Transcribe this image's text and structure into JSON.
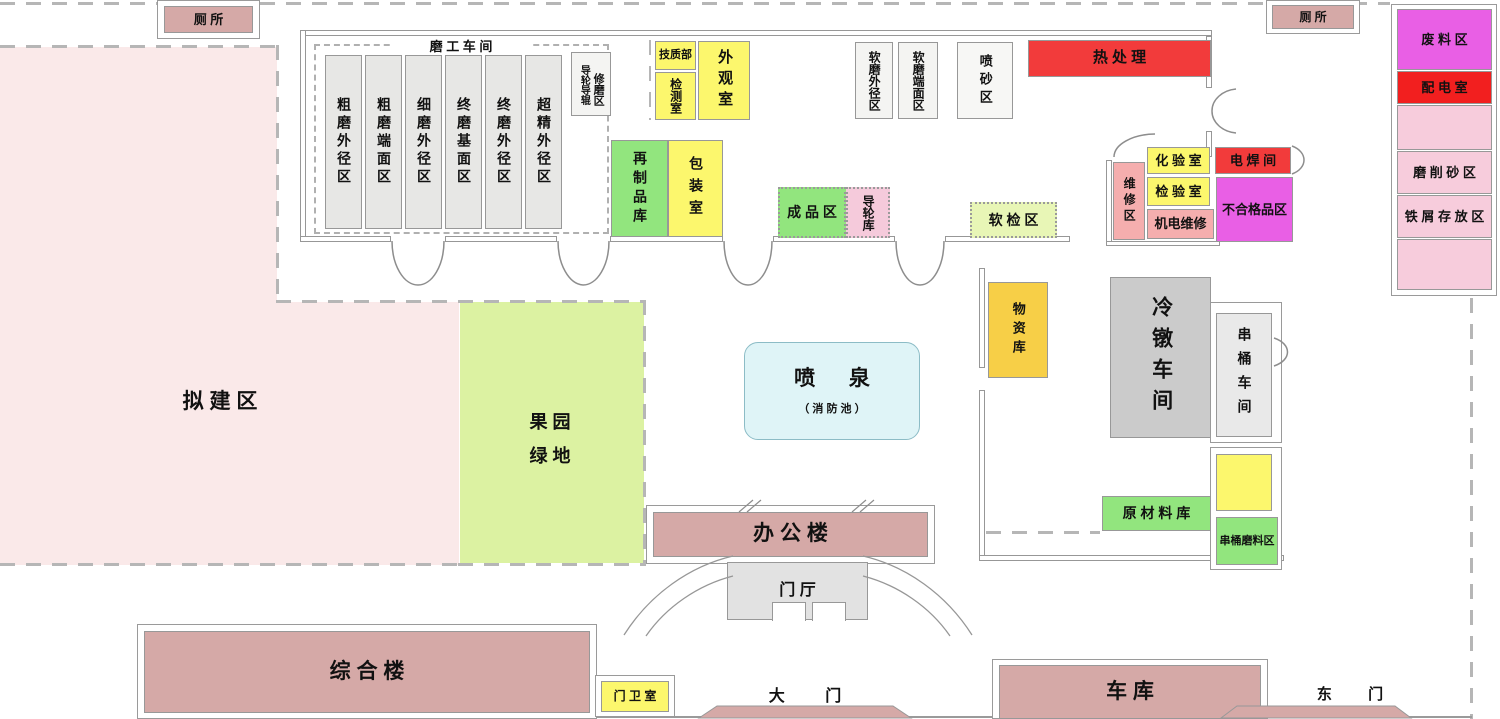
{
  "palette": {
    "building_mauve": "#D5A9A7",
    "proposed_pink": "#FAE9E9",
    "orchard_green": "#DCF2A2",
    "strip_gray": "#E7E7E5",
    "lemon_yellow": "#FCF76D",
    "gold_yellow": "#F7CF47",
    "hot_red": "#F23B3B",
    "power_red": "#F21F1F",
    "fresh_green": "#92E57E",
    "magenta": "#E95FE5",
    "soft_pink": "#F5AEAE",
    "pale_rose": "#F5CADB",
    "pale_lime": "#E8F6B6",
    "fountain_cyan": "#DFF4F7",
    "cold_gray": "#CBCBCB",
    "light_gray": "#E9E9E9",
    "wall_gray": "#989898"
  },
  "toilets": {
    "nw": "厕  所",
    "ne": "厕  所"
  },
  "grounds": {
    "proposed_area": "拟  建  区",
    "orchard_line1": "果  园",
    "orchard_line2": "绿  地"
  },
  "workshop": {
    "title": "磨 工 车 间",
    "strips": [
      "粗磨外径区",
      "粗磨端面区",
      "细磨外径区",
      "终磨基面区",
      "终磨外径区",
      "超精外径区"
    ],
    "regrind_line1": "导轮导辊",
    "regrind_line2": "修磨区",
    "tech_dept": "技质部",
    "testing_room": "检测室",
    "appearance_room": "外观室",
    "soft_grind_od": "软磨外径区",
    "soft_grind_face": "软磨端面区",
    "sandblast": "喷砂区",
    "heat_treatment": "热  处  理"
  },
  "mid": {
    "remanufactured_store": "再制品库",
    "packing_room": "包装室",
    "finished_goods": "成 品 区",
    "guide_wheel_store": "导轮库",
    "soft_inspection": "软 检 区"
  },
  "qc": {
    "lab": "化 验 室",
    "welding_room": "电 焊 间",
    "maintenance_area": "维修区",
    "inspection_room": "检 验 室",
    "mech_elec_maintenance": "机电维修",
    "nonconforming_area": "不合格品区"
  },
  "fountain": {
    "title": "喷  泉",
    "subtitle": "（ 消 防 池 ）"
  },
  "east_zone": {
    "materials_store": "物资库",
    "cold_heading_shop": "冷镦车间",
    "tumbling_shop": "串桶车间",
    "raw_materials_store": "原 材 料 库",
    "tumbling_abrasive_area": "串桶磨料区"
  },
  "east_column": {
    "waste_area": "废 料 区",
    "power_room": "配 电 室",
    "grinding_sand_area": "磨 削 砂 区",
    "iron_chip_area": "铁 屑 存 放 区"
  },
  "south": {
    "office_building": "办  公  楼",
    "lobby": "门  厅",
    "complex_building": "综  合  楼",
    "guard_room": "门 卫 室",
    "main_gate": "大  门",
    "garage": "车  库",
    "east_gate": "东  门"
  }
}
